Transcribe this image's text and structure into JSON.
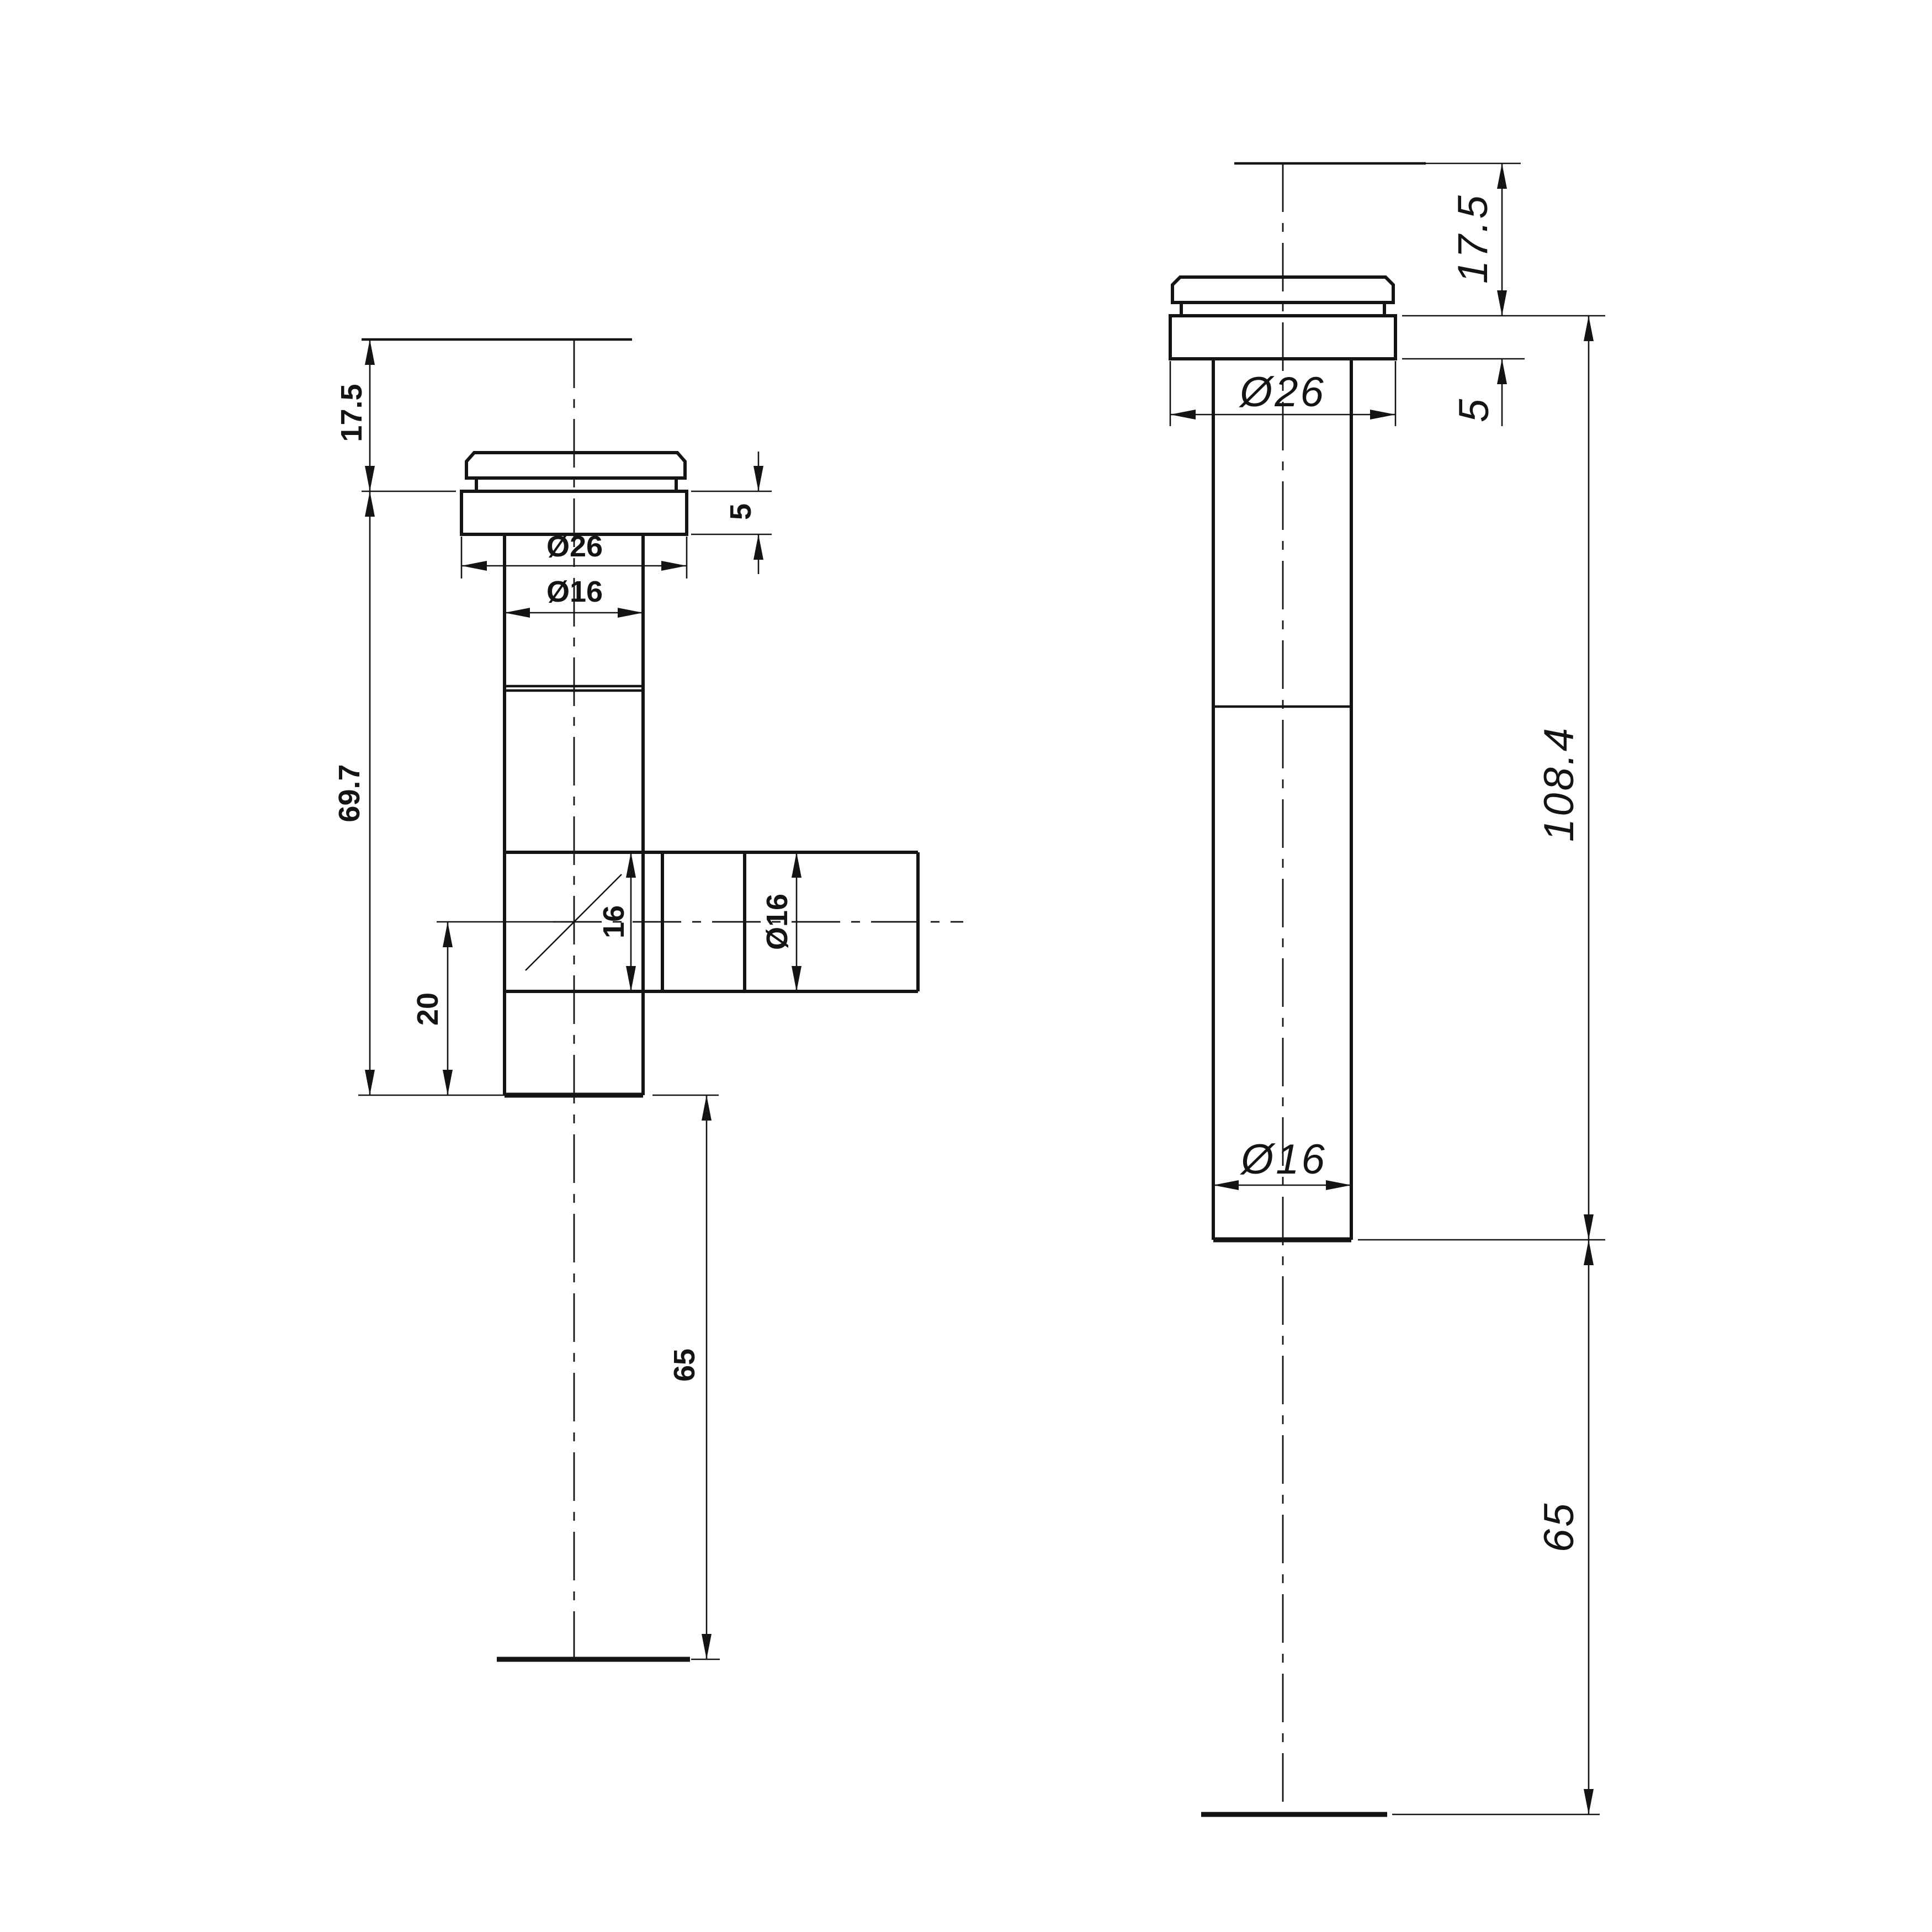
{
  "colors": {
    "ink": "#141414",
    "background": "#ffffff"
  },
  "left_view": {
    "dims": {
      "top_height": "17.5",
      "flange_thickness": "5",
      "flange_diameter": "Ø26",
      "upper_stem_diameter": "Ø16",
      "body_length": "69.7",
      "branch_center_to_end": "20",
      "branch_bore": "16",
      "branch_diameter": "Ø16",
      "tail_length": "65"
    }
  },
  "right_view": {
    "dims": {
      "top_height": "17.5",
      "flange_thickness": "5",
      "flange_diameter": "Ø26",
      "stem_diameter": "Ø16",
      "overall_length": "108.4",
      "tail_length": "65"
    }
  }
}
